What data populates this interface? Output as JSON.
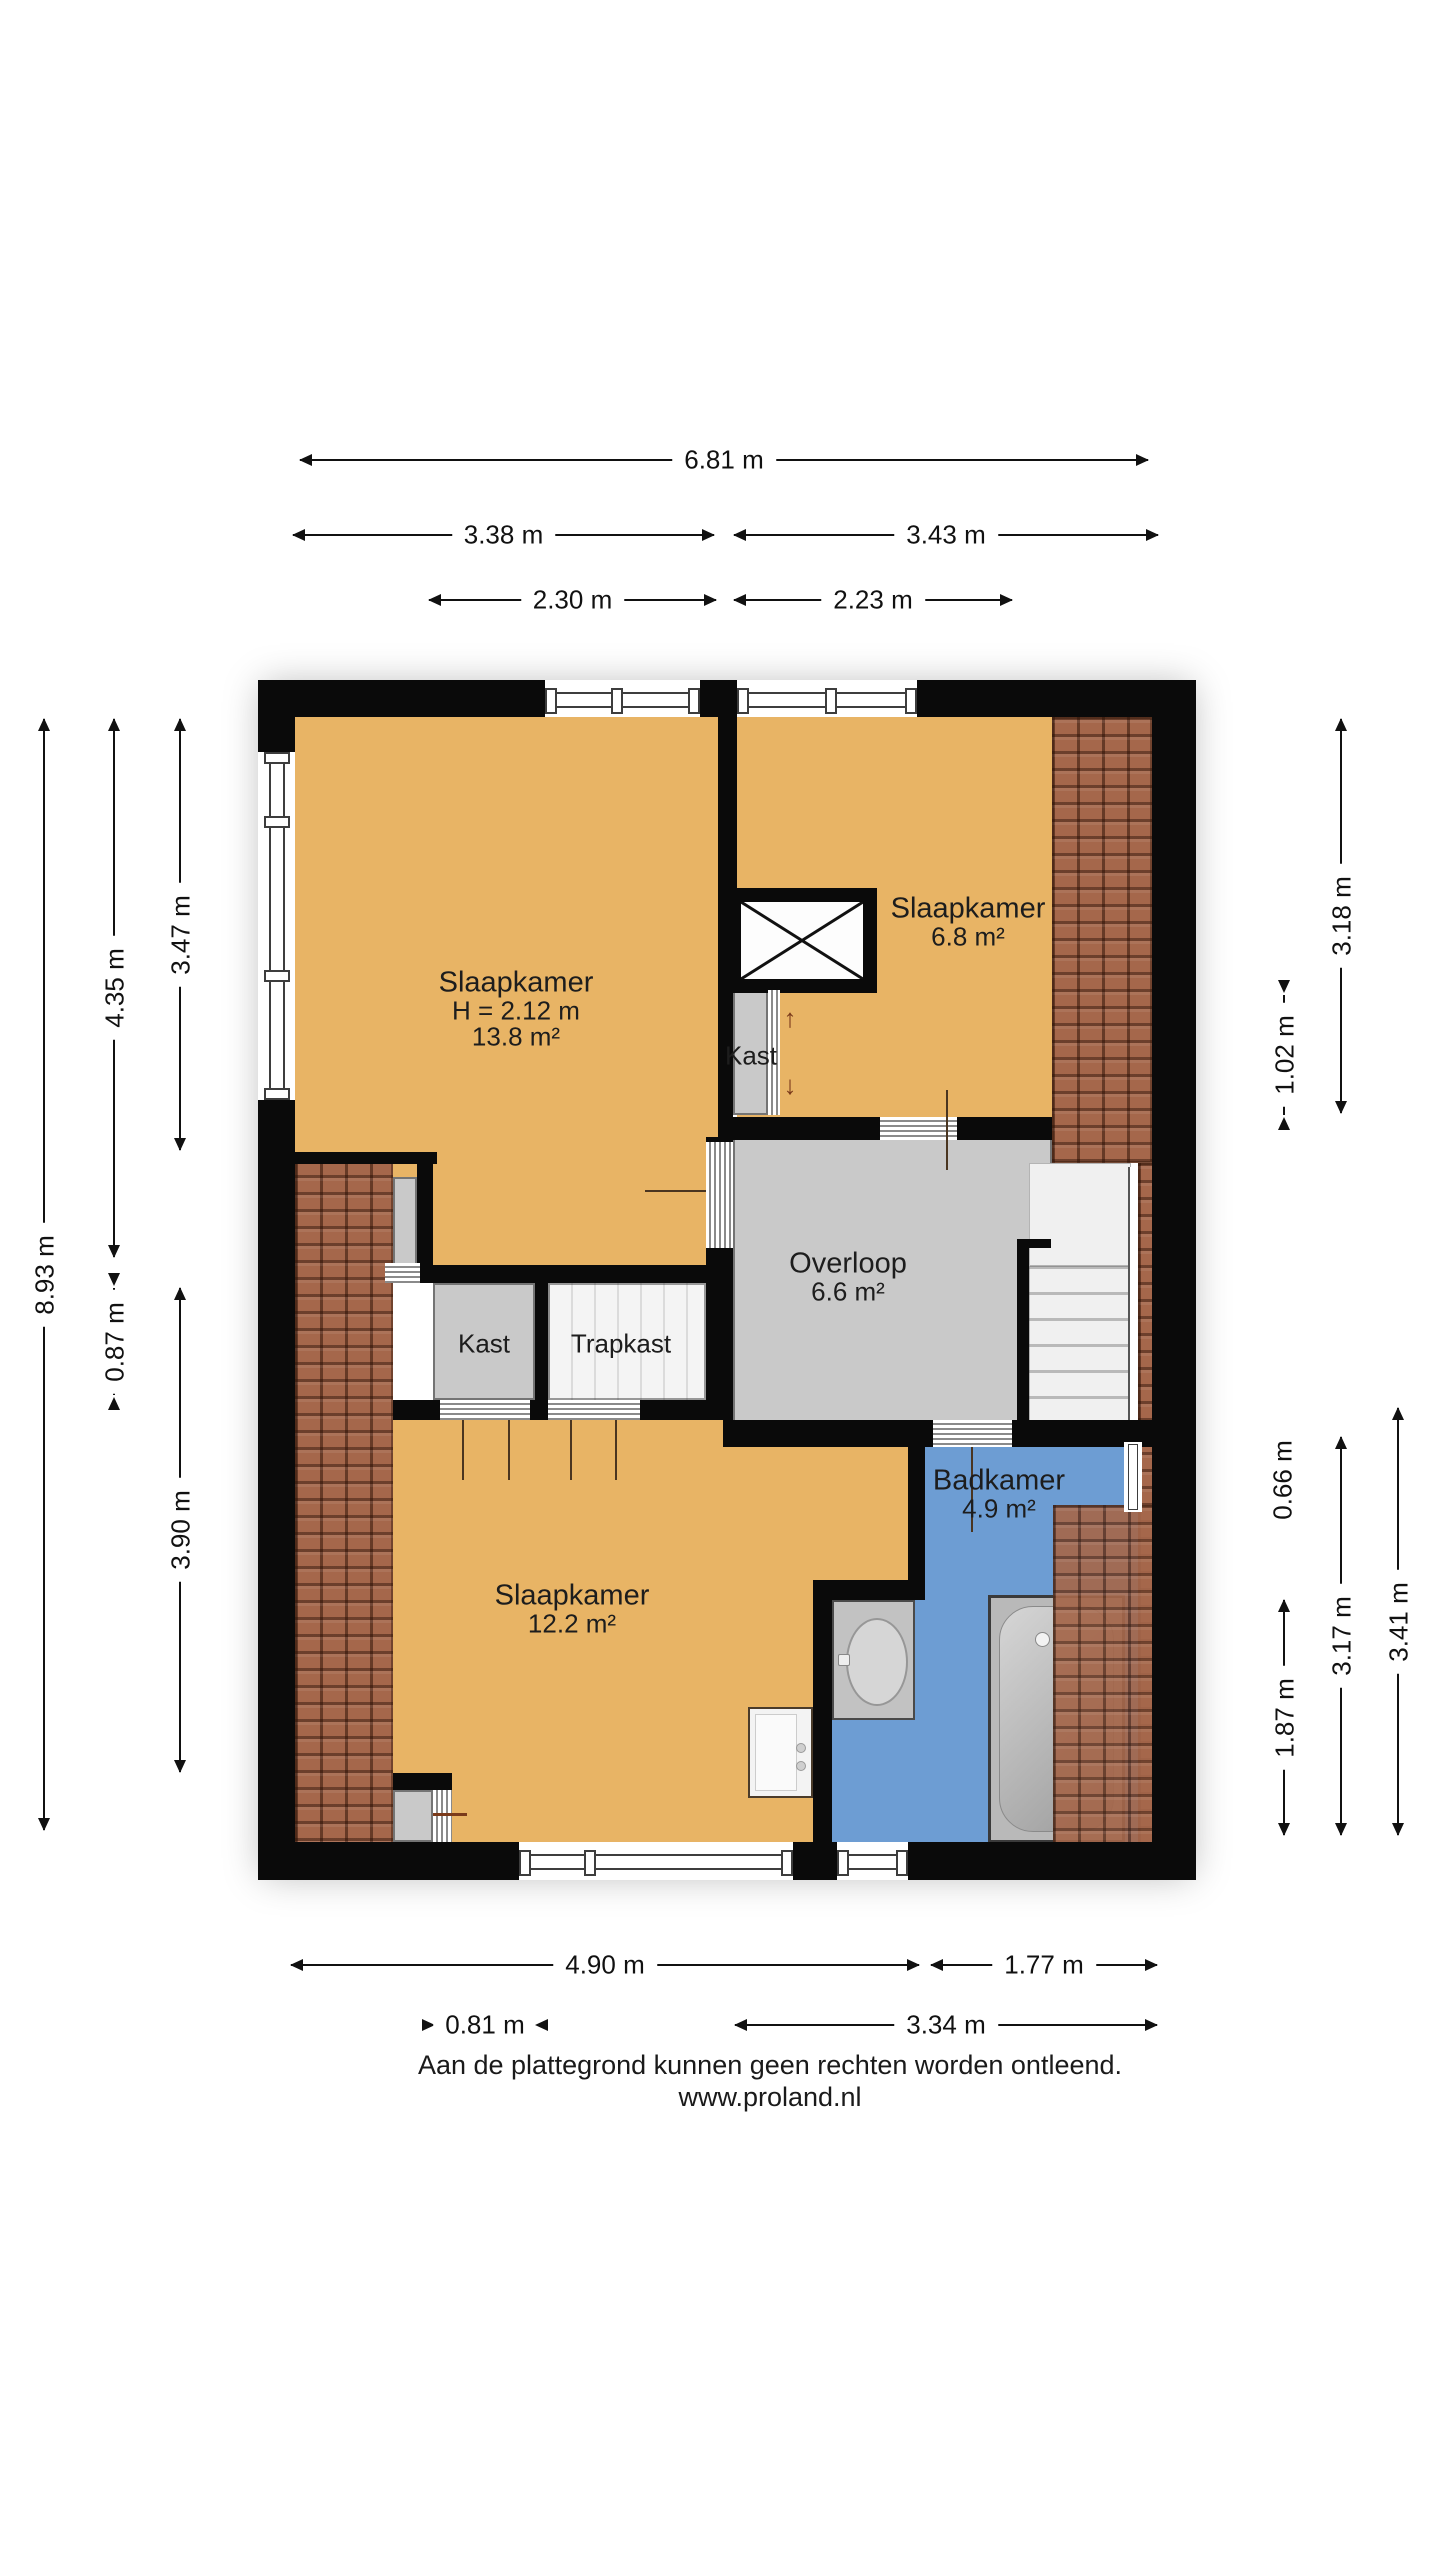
{
  "rooms": {
    "bedroom_large": {
      "name": "Slaapkamer",
      "ceiling": "H = 2.12 m",
      "area": "13.8 m²"
    },
    "bedroom_small": {
      "name": "Slaapkamer",
      "area": "6.8 m²"
    },
    "landing": {
      "name": "Overloop",
      "area": "6.6 m²"
    },
    "closet_small": {
      "name": "Kast"
    },
    "closet": {
      "name": "Kast"
    },
    "stair_closet": {
      "name": "Trapkast"
    },
    "bedroom_bottom": {
      "name": "Slaapkamer",
      "area": "12.2 m²"
    },
    "bathroom": {
      "name": "Badkamer",
      "area": "4.9 m²"
    }
  },
  "dimensions": {
    "top": {
      "total": "6.81 m",
      "left": "3.38 m",
      "right": "3.43 m",
      "inner_left": "2.30 m",
      "inner_right": "2.23 m"
    },
    "left": {
      "total": "8.93 m",
      "upper": "4.35 m",
      "middle": "0.87 m",
      "inner_upper": "3.47 m",
      "inner_lower": "3.90 m"
    },
    "right": {
      "upper": "3.18 m",
      "upper_small": "1.02 m",
      "small": "0.66 m",
      "lower_small": "1.87 m",
      "lower": "3.17 m",
      "lower_outer": "3.41 m"
    },
    "bottom": {
      "left": "4.90 m",
      "right": "1.77 m",
      "small": "0.81 m",
      "lower_right": "3.34 m"
    }
  },
  "icons": {
    "slide_up": "↑",
    "slide_down": "↓"
  },
  "footer": {
    "disclaimer": "Aan de plattegrond kunnen geen rechten worden ontleend.",
    "website": "www.proland.nl"
  },
  "colors": {
    "wall": "#0a0a0a",
    "floor": "#e8b465",
    "landing_floor": "#c9c9c9",
    "bathroom_floor": "#6d9dd3",
    "roof_tiles": "#a5674b"
  }
}
